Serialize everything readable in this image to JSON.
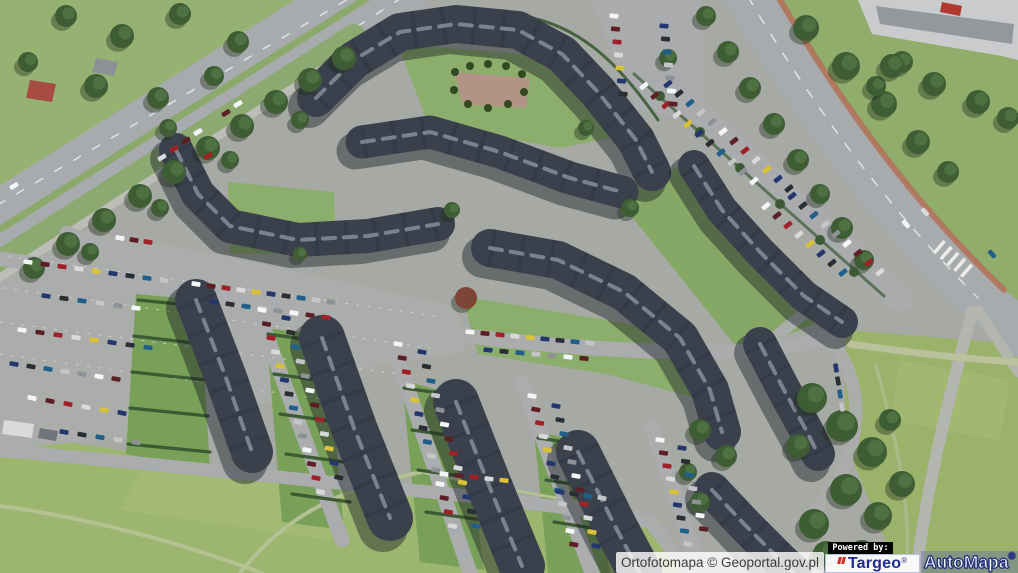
{
  "overlay": {
    "attribution": "Ortofotomapa © Geoportal.gov.pl",
    "powered_by_label": "Powered by:",
    "targeo_text": "Targeo",
    "targeo_reg": "®",
    "automapa_text": "AutoMapa",
    "automapa_reg": "®",
    "colors": {
      "targeo_blue": "#1e2b8f",
      "targeo_red": "#d6281e",
      "automapa_fill": "#ffffff",
      "automapa_outline": "#27357f",
      "powered_bg": "#040404",
      "powered_fg": "#ffffff",
      "strip_bg": "rgba(255,255,255,0.8)",
      "strip_fg": "#3c3c3c"
    }
  },
  "scene": {
    "base": "#a6a9a4",
    "bcolors": {
      "shadow": "rgba(20,24,32,0.42)",
      "body": "#3a414d",
      "tex": "#2c323d",
      "ridge": "#828a96"
    },
    "car_palette": [
      "#f4f5f6",
      "#d8d9da",
      "#2a2d33",
      "#8e9296",
      "#9e2227",
      "#23366e",
      "#c4c5c7",
      "#5c1f24",
      "#d9c13a",
      "#1f5f8a"
    ],
    "polys": [
      {
        "pts": "0,0 352,0 196,78 0,196",
        "f": "#96b273"
      },
      {
        "pts": "760,0 1018,0 1018,310 982,292 846,108 794,36",
        "f": "#90ad6b"
      },
      {
        "pts": "846,330 1018,344 1018,573 898,573 844,438",
        "f": "#9ab26a"
      },
      {
        "pts": "0,432 240,468 430,486 642,514 692,573 0,573",
        "f": "#9cb56f"
      },
      {
        "pts": "140,470 360,492 330,540 120,510",
        "f": "#a8bd79",
        "o": 0.55
      },
      {
        "pts": "900,360 1010,380 1000,440 890,420",
        "f": "#a9bd78",
        "o": 0.5
      },
      {
        "pts": "590,0 702,0 706,120 636,110",
        "f": "#a9abad"
      },
      {
        "pts": "0,216 206,252 456,306 466,352 380,364 180,432 0,450",
        "f": "#abadab"
      },
      {
        "pts": "398,44 592,60 650,130 560,148 428,124",
        "f": "#8cae6c"
      },
      {
        "pts": "455,72 530,78 526,108 462,104",
        "f": "#b29487"
      },
      {
        "pts": "228,182 334,192 336,254 230,254",
        "f": "#8cae6c"
      },
      {
        "pts": "462,296 678,332 704,400 606,374 478,354",
        "f": "#8cae6c"
      },
      {
        "pts": "612,192 694,162 814,324 742,354",
        "f": "#86a866"
      },
      {
        "pts": "136,294 200,300 210,470 126,454",
        "f": "#79a058"
      },
      {
        "pts": "266,328 326,336 344,530 282,522",
        "f": "#79a058"
      },
      {
        "pts": "402,380 460,396 484,570 420,562",
        "f": "#79a058"
      },
      {
        "pts": "534,430 588,444 610,573 548,573",
        "f": "#79a058"
      },
      {
        "pts": "858,0 1018,0 1018,60 1002,56 872,34",
        "f": "#c9cbcd"
      },
      {
        "pts": "876,6 1014,24 1012,44 880,24",
        "f": "#94989d"
      },
      {
        "pts": "942,2 962,6 960,16 940,12",
        "f": "#b03a30"
      },
      {
        "pts": "4,420 34,424 32,438 2,434",
        "f": "#dadbd8"
      },
      {
        "pts": "40,428 58,431 56,441 38,438",
        "f": "#70747a"
      },
      {
        "pts": "30,80 56,84 52,102 26,98",
        "f": "#a84b42"
      },
      {
        "pts": "96,58 118,62 114,76 92,72",
        "f": "#8d9196"
      }
    ],
    "strokes": [
      {
        "d": "M 402,-24 L -52,262",
        "w": 74,
        "c": "#a8abad"
      },
      {
        "d": "M 402,-24 L -52,262",
        "w": 7,
        "c": "#8aa96b"
      },
      {
        "d": "M 384,-22 L -62,240",
        "w": 1.5,
        "c": "#e2e3e1",
        "dash": "8 14"
      },
      {
        "d": "M 420,-14 L -40,282",
        "w": 1.5,
        "c": "#e2e3e1",
        "dash": "8 14"
      },
      {
        "d": "M 354,36 L -44,290",
        "w": 24,
        "c": "#8aa96b",
        "o": 0.9
      },
      {
        "d": "M 336,60 L -32,298",
        "w": 8,
        "c": "#bcbdb7"
      },
      {
        "d": "M 737,-22 C 805,95 880,200 978,298 L 1042,348",
        "w": 46,
        "c": "#a8abad"
      },
      {
        "d": "M 737,-22 C 805,95 880,200 978,298",
        "w": 1.5,
        "c": "#e2e3e1",
        "dash": "9 13"
      },
      {
        "d": "M 766,-24 C 833,92 906,196 1004,290",
        "w": 6,
        "c": "#b5705c",
        "o": 0.85
      },
      {
        "d": "M 938,246 L 968,272",
        "w": 16,
        "c": "#ebecea",
        "dash": "3.5 5.5",
        "cap": "butt"
      },
      {
        "d": "M 972,312 C 948,400 928,480 916,573",
        "w": 12,
        "c": "#b3b5af"
      },
      {
        "d": "M 978,310 L 1018,372",
        "w": 10,
        "c": "#b3b5af"
      },
      {
        "d": "M 850,344 C 920,354 980,360 1018,362",
        "w": 7,
        "c": "#b9c29a"
      },
      {
        "d": "M 876,366 C 900,450 912,520 906,573",
        "w": 3.5,
        "c": "#aabb8a"
      },
      {
        "d": "M 240,573 C 282,520 332,490 422,472",
        "w": 4,
        "c": "#b3c193"
      },
      {
        "d": "M 0,506 C 120,522 222,558 262,573",
        "w": 4,
        "c": "#b3c193"
      },
      {
        "d": "M 422,472 C 520,494 600,502 658,522",
        "w": 3,
        "c": "#b3c193"
      },
      {
        "d": "M -5,258 C 150,280 300,312 452,334 C 560,348 640,352 708,352 C 770,352 802,346 826,336",
        "w": 15,
        "c": "#aaacae"
      },
      {
        "d": "M 642,62 L 900,298",
        "w": 27,
        "c": "#a9abad"
      },
      {
        "d": "M 596,-6 L 642,62",
        "w": 18,
        "c": "#a9abad"
      },
      {
        "d": "M 826,336 C 852,362 862,402 852,442 C 845,472 834,492 816,508",
        "w": 13,
        "c": "#abadab"
      },
      {
        "d": "M 762,348 L 818,302",
        "w": 12,
        "c": "#abadab"
      },
      {
        "d": "M 252,296 L 342,540",
        "w": 15,
        "c": "#aaacae"
      },
      {
        "d": "M 388,330 L 470,573",
        "w": 15,
        "c": "#aaacae"
      },
      {
        "d": "M 522,382 L 592,573",
        "w": 15,
        "c": "#aaacae"
      },
      {
        "d": "M 652,428 L 702,573",
        "w": 15,
        "c": "#aaacae"
      },
      {
        "d": "M -5,450 C 140,462 300,480 430,492 C 540,504 606,512 650,522 L 690,573",
        "w": 13,
        "c": "#aaacae"
      },
      {
        "d": "M 66,232 L 152,262",
        "w": 12,
        "c": "#aaacae"
      },
      {
        "d": "M 8,256 L 436,316",
        "w": 1,
        "c": "#d8d9d6",
        "dash": "2 9",
        "o": 0.8
      },
      {
        "d": "M 4,288 L 430,348",
        "w": 1,
        "c": "#d8d9d6",
        "dash": "2 9",
        "o": 0.8
      },
      {
        "d": "M 0,322 L 398,374",
        "w": 1,
        "c": "#d8d9d6",
        "dash": "2 9",
        "o": 0.8
      },
      {
        "d": "M 0,354 L 330,400",
        "w": 1,
        "c": "#d8d9d6",
        "dash": "2 9",
        "o": 0.8
      },
      {
        "d": "M 306,88 C 354,30 442,4 524,16 C 576,26 614,56 658,120",
        "w": 3,
        "c": "#3c5a33",
        "o": 0.9
      },
      {
        "d": "M 634,74 L 884,296",
        "w": 3,
        "c": "#3c5a33",
        "o": 0.7
      },
      {
        "d": "M 138,300 L 198,306",
        "w": 3.2,
        "c": "#3c5a33"
      },
      {
        "d": "M 134,336 L 202,344",
        "w": 3.2,
        "c": "#3c5a33"
      },
      {
        "d": "M 132,372 L 206,380",
        "w": 3.2,
        "c": "#3c5a33"
      },
      {
        "d": "M 130,408 L 208,416",
        "w": 3.2,
        "c": "#3c5a33"
      },
      {
        "d": "M 128,444 L 210,452",
        "w": 3.2,
        "c": "#3c5a33"
      },
      {
        "d": "M 268,334 L 324,342",
        "w": 3.2,
        "c": "#3c5a33"
      },
      {
        "d": "M 274,374 L 332,382",
        "w": 3.2,
        "c": "#3c5a33"
      },
      {
        "d": "M 280,414 L 338,422",
        "w": 3.2,
        "c": "#3c5a33"
      },
      {
        "d": "M 286,454 L 344,462",
        "w": 3.2,
        "c": "#3c5a33"
      },
      {
        "d": "M 292,494 L 350,502",
        "w": 3.2,
        "c": "#3c5a33"
      },
      {
        "d": "M 404,388 L 460,396",
        "w": 3.2,
        "c": "#3c5a33"
      },
      {
        "d": "M 412,430 L 468,438",
        "w": 3.2,
        "c": "#3c5a33"
      },
      {
        "d": "M 418,470 L 474,478",
        "w": 3.2,
        "c": "#3c5a33"
      },
      {
        "d": "M 426,512 L 482,520",
        "w": 3.2,
        "c": "#3c5a33"
      },
      {
        "d": "M 538,438 L 592,446",
        "w": 3.2,
        "c": "#3c5a33"
      },
      {
        "d": "M 546,480 L 598,488",
        "w": 3.2,
        "c": "#3c5a33"
      },
      {
        "d": "M 554,522 L 604,530",
        "w": 3.2,
        "c": "#3c5a33"
      }
    ],
    "buildings": [
      {
        "d": "M 316,98 L 354,60 L 400,32 L 456,24 L 518,30 L 562,54 L 598,92 L 636,140 L 652,172",
        "w": 38
      },
      {
        "d": "M 362,142 L 430,132 L 500,152 L 570,178 L 622,192",
        "w": 33
      },
      {
        "d": "M 176,150 L 198,194 L 230,226 L 298,240 L 368,236 L 438,224",
        "w": 34
      },
      {
        "d": "M 490,248 L 558,260 L 624,292 L 680,338 L 710,390 L 722,432",
        "w": 38
      },
      {
        "d": "M 694,166 L 722,210 L 760,252 L 804,296 L 842,322",
        "w": 32
      },
      {
        "d": "M 760,344 L 784,390 L 806,430 L 818,454",
        "w": 34
      },
      {
        "d": "M 712,490 L 746,526 L 780,560 L 794,573",
        "w": 36
      },
      {
        "d": "M 196,300 L 226,378 L 252,452",
        "w": 42
      },
      {
        "d": "M 322,338 L 354,428 L 390,518",
        "w": 46
      },
      {
        "d": "M 456,402 L 490,488 L 522,566",
        "w": 46
      },
      {
        "d": "M 578,452 L 616,528 L 640,573",
        "w": 44
      }
    ],
    "trees": [
      [
        344,
        58,
        12
      ],
      [
        310,
        80,
        12
      ],
      [
        276,
        102,
        12
      ],
      [
        242,
        126,
        12
      ],
      [
        208,
        148,
        12
      ],
      [
        174,
        172,
        12
      ],
      [
        140,
        196,
        12
      ],
      [
        104,
        220,
        12
      ],
      [
        68,
        244,
        12
      ],
      [
        34,
        268,
        11
      ],
      [
        300,
        120,
        9
      ],
      [
        230,
        160,
        9
      ],
      [
        160,
        208,
        9
      ],
      [
        90,
        252,
        9
      ],
      [
        66,
        16,
        11
      ],
      [
        122,
        36,
        12
      ],
      [
        180,
        14,
        11
      ],
      [
        238,
        42,
        11
      ],
      [
        28,
        62,
        10
      ],
      [
        96,
        86,
        12
      ],
      [
        158,
        98,
        11
      ],
      [
        214,
        76,
        10
      ],
      [
        706,
        16,
        10
      ],
      [
        728,
        52,
        11
      ],
      [
        750,
        88,
        11
      ],
      [
        774,
        124,
        11
      ],
      [
        798,
        160,
        11
      ],
      [
        820,
        194,
        10
      ],
      [
        842,
        228,
        11
      ],
      [
        864,
        260,
        10
      ],
      [
        806,
        28,
        13
      ],
      [
        846,
        66,
        14
      ],
      [
        884,
        104,
        13
      ],
      [
        918,
        142,
        12
      ],
      [
        902,
        62,
        11
      ],
      [
        948,
        172,
        11
      ],
      [
        876,
        86,
        10
      ],
      [
        892,
        66,
        12
      ],
      [
        934,
        84,
        12
      ],
      [
        978,
        102,
        12
      ],
      [
        1008,
        118,
        11
      ],
      [
        812,
        398,
        15
      ],
      [
        842,
        426,
        16
      ],
      [
        872,
        452,
        15
      ],
      [
        846,
        490,
        16
      ],
      [
        814,
        524,
        15
      ],
      [
        878,
        516,
        14
      ],
      [
        902,
        484,
        13
      ],
      [
        826,
        554,
        13
      ],
      [
        862,
        554,
        14
      ],
      [
        798,
        446,
        12
      ],
      [
        890,
        420,
        11
      ],
      [
        168,
        128,
        9
      ],
      [
        452,
        210,
        8
      ],
      [
        300,
        254,
        7
      ],
      [
        630,
        208,
        9
      ],
      [
        586,
        128,
        8
      ],
      [
        668,
        58,
        9
      ],
      [
        466,
        298,
        11,
        "#7e4438"
      ],
      [
        700,
        430,
        11
      ],
      [
        726,
        456,
        11
      ],
      [
        688,
        472,
        9
      ],
      [
        700,
        502,
        10
      ],
      [
        455,
        72,
        4,
        "#32491f"
      ],
      [
        470,
        66,
        4,
        "#32491f"
      ],
      [
        488,
        64,
        4,
        "#32491f"
      ],
      [
        506,
        66,
        4,
        "#32491f"
      ],
      [
        522,
        74,
        4,
        "#32491f"
      ],
      [
        524,
        92,
        4,
        "#32491f"
      ],
      [
        508,
        104,
        4,
        "#32491f"
      ],
      [
        488,
        108,
        4,
        "#32491f"
      ],
      [
        468,
        104,
        4,
        "#32491f"
      ],
      [
        454,
        90,
        4,
        "#32491f"
      ],
      [
        660,
        96,
        5,
        "#3c5a33"
      ],
      [
        700,
        132,
        5,
        "#3c5a33"
      ],
      [
        740,
        168,
        5,
        "#3c5a33"
      ],
      [
        780,
        204,
        5,
        "#3c5a33"
      ],
      [
        820,
        240,
        5,
        "#3c5a33"
      ],
      [
        854,
        272,
        5,
        "#3c5a33"
      ]
    ],
    "cars": [
      {
        "x": 28,
        "y": 262,
        "a": 8,
        "dx": 17,
        "dy": 2.3,
        "n": 9
      },
      {
        "x": 46,
        "y": 296,
        "a": 8,
        "dx": 18,
        "dy": 2.4,
        "n": 6
      },
      {
        "x": 22,
        "y": 330,
        "a": 8,
        "dx": 18,
        "dy": 2.5,
        "n": 8
      },
      {
        "x": 14,
        "y": 364,
        "a": 10,
        "dx": 17,
        "dy": 2.5,
        "n": 7
      },
      {
        "x": 32,
        "y": 398,
        "a": 12,
        "dx": 18,
        "dy": 3,
        "n": 6
      },
      {
        "x": 64,
        "y": 432,
        "a": 10,
        "dx": 18,
        "dy": 2.6,
        "n": 5
      },
      {
        "x": 196,
        "y": 284,
        "a": 9,
        "dx": 15,
        "dy": 2,
        "n": 10
      },
      {
        "x": 214,
        "y": 302,
        "a": 9,
        "dx": 16,
        "dy": 2.2,
        "n": 8
      },
      {
        "x": 470,
        "y": 332,
        "a": 6,
        "dx": 15,
        "dy": 1.4,
        "n": 9
      },
      {
        "x": 488,
        "y": 350,
        "a": 6,
        "dx": 16,
        "dy": 1.4,
        "n": 7
      },
      {
        "x": 644,
        "y": 86,
        "a": 142,
        "dx": 11,
        "dy": 9.5,
        "n": 11
      },
      {
        "x": 668,
        "y": 84,
        "a": 142,
        "dx": 11,
        "dy": 9.5,
        "n": 12
      },
      {
        "x": 766,
        "y": 206,
        "a": 142,
        "dx": 11,
        "dy": 9.5,
        "n": 8
      },
      {
        "x": 792,
        "y": 196,
        "a": 142,
        "dx": 11,
        "dy": 9.5,
        "n": 9
      },
      {
        "x": 614,
        "y": 16,
        "a": 5,
        "dx": 1.5,
        "dy": 13,
        "n": 7
      },
      {
        "x": 664,
        "y": 26,
        "a": 5,
        "dx": 1.5,
        "dy": 13,
        "n": 7
      },
      {
        "x": 262,
        "y": 310,
        "a": 10,
        "dx": 4.5,
        "dy": 14,
        "n": 14
      },
      {
        "x": 286,
        "y": 318,
        "a": 10,
        "dx": 4.8,
        "dy": 14.5,
        "n": 12
      },
      {
        "x": 398,
        "y": 344,
        "a": 10,
        "dx": 4.2,
        "dy": 14,
        "n": 14
      },
      {
        "x": 422,
        "y": 352,
        "a": 10,
        "dx": 4.5,
        "dy": 14.5,
        "n": 13
      },
      {
        "x": 532,
        "y": 396,
        "a": 10,
        "dx": 3.8,
        "dy": 13.5,
        "n": 12
      },
      {
        "x": 556,
        "y": 406,
        "a": 10,
        "dx": 4,
        "dy": 14,
        "n": 11
      },
      {
        "x": 660,
        "y": 440,
        "a": 8,
        "dx": 3.5,
        "dy": 13,
        "n": 9
      },
      {
        "x": 682,
        "y": 448,
        "a": 8,
        "dx": 3.6,
        "dy": 13.5,
        "n": 7
      },
      {
        "x": 444,
        "y": 474,
        "a": 7,
        "dx": 15,
        "dy": 1.6,
        "n": 5
      },
      {
        "x": 560,
        "y": 492,
        "a": 12,
        "dx": 14,
        "dy": 2,
        "n": 4
      },
      {
        "x": 906,
        "y": 224,
        "a": 48,
        "dx": 0,
        "dy": 0,
        "n": 1,
        "ci": 0
      },
      {
        "x": 992,
        "y": 254,
        "a": 48,
        "dx": 0,
        "dy": 0,
        "n": 1,
        "ci": 9
      },
      {
        "x": 925,
        "y": 212,
        "a": 48,
        "dx": 0,
        "dy": 0,
        "n": 1,
        "ci": 1
      },
      {
        "x": 208,
        "y": 156,
        "a": -32,
        "dx": 0,
        "dy": 0,
        "n": 1,
        "ci": 4
      },
      {
        "x": 238,
        "y": 104,
        "a": -32,
        "dx": -12,
        "dy": 9,
        "n": 2
      },
      {
        "x": 14,
        "y": 186,
        "a": -32,
        "dx": 0,
        "dy": 0,
        "n": 1,
        "ci": 0
      },
      {
        "x": 120,
        "y": 238,
        "a": 9,
        "dx": 14,
        "dy": 2,
        "n": 3
      },
      {
        "x": 836,
        "y": 368,
        "a": 80,
        "dx": 2,
        "dy": 13,
        "n": 4
      },
      {
        "x": 198,
        "y": 132,
        "a": -32,
        "dx": -12,
        "dy": 8.5,
        "n": 4
      }
    ]
  }
}
